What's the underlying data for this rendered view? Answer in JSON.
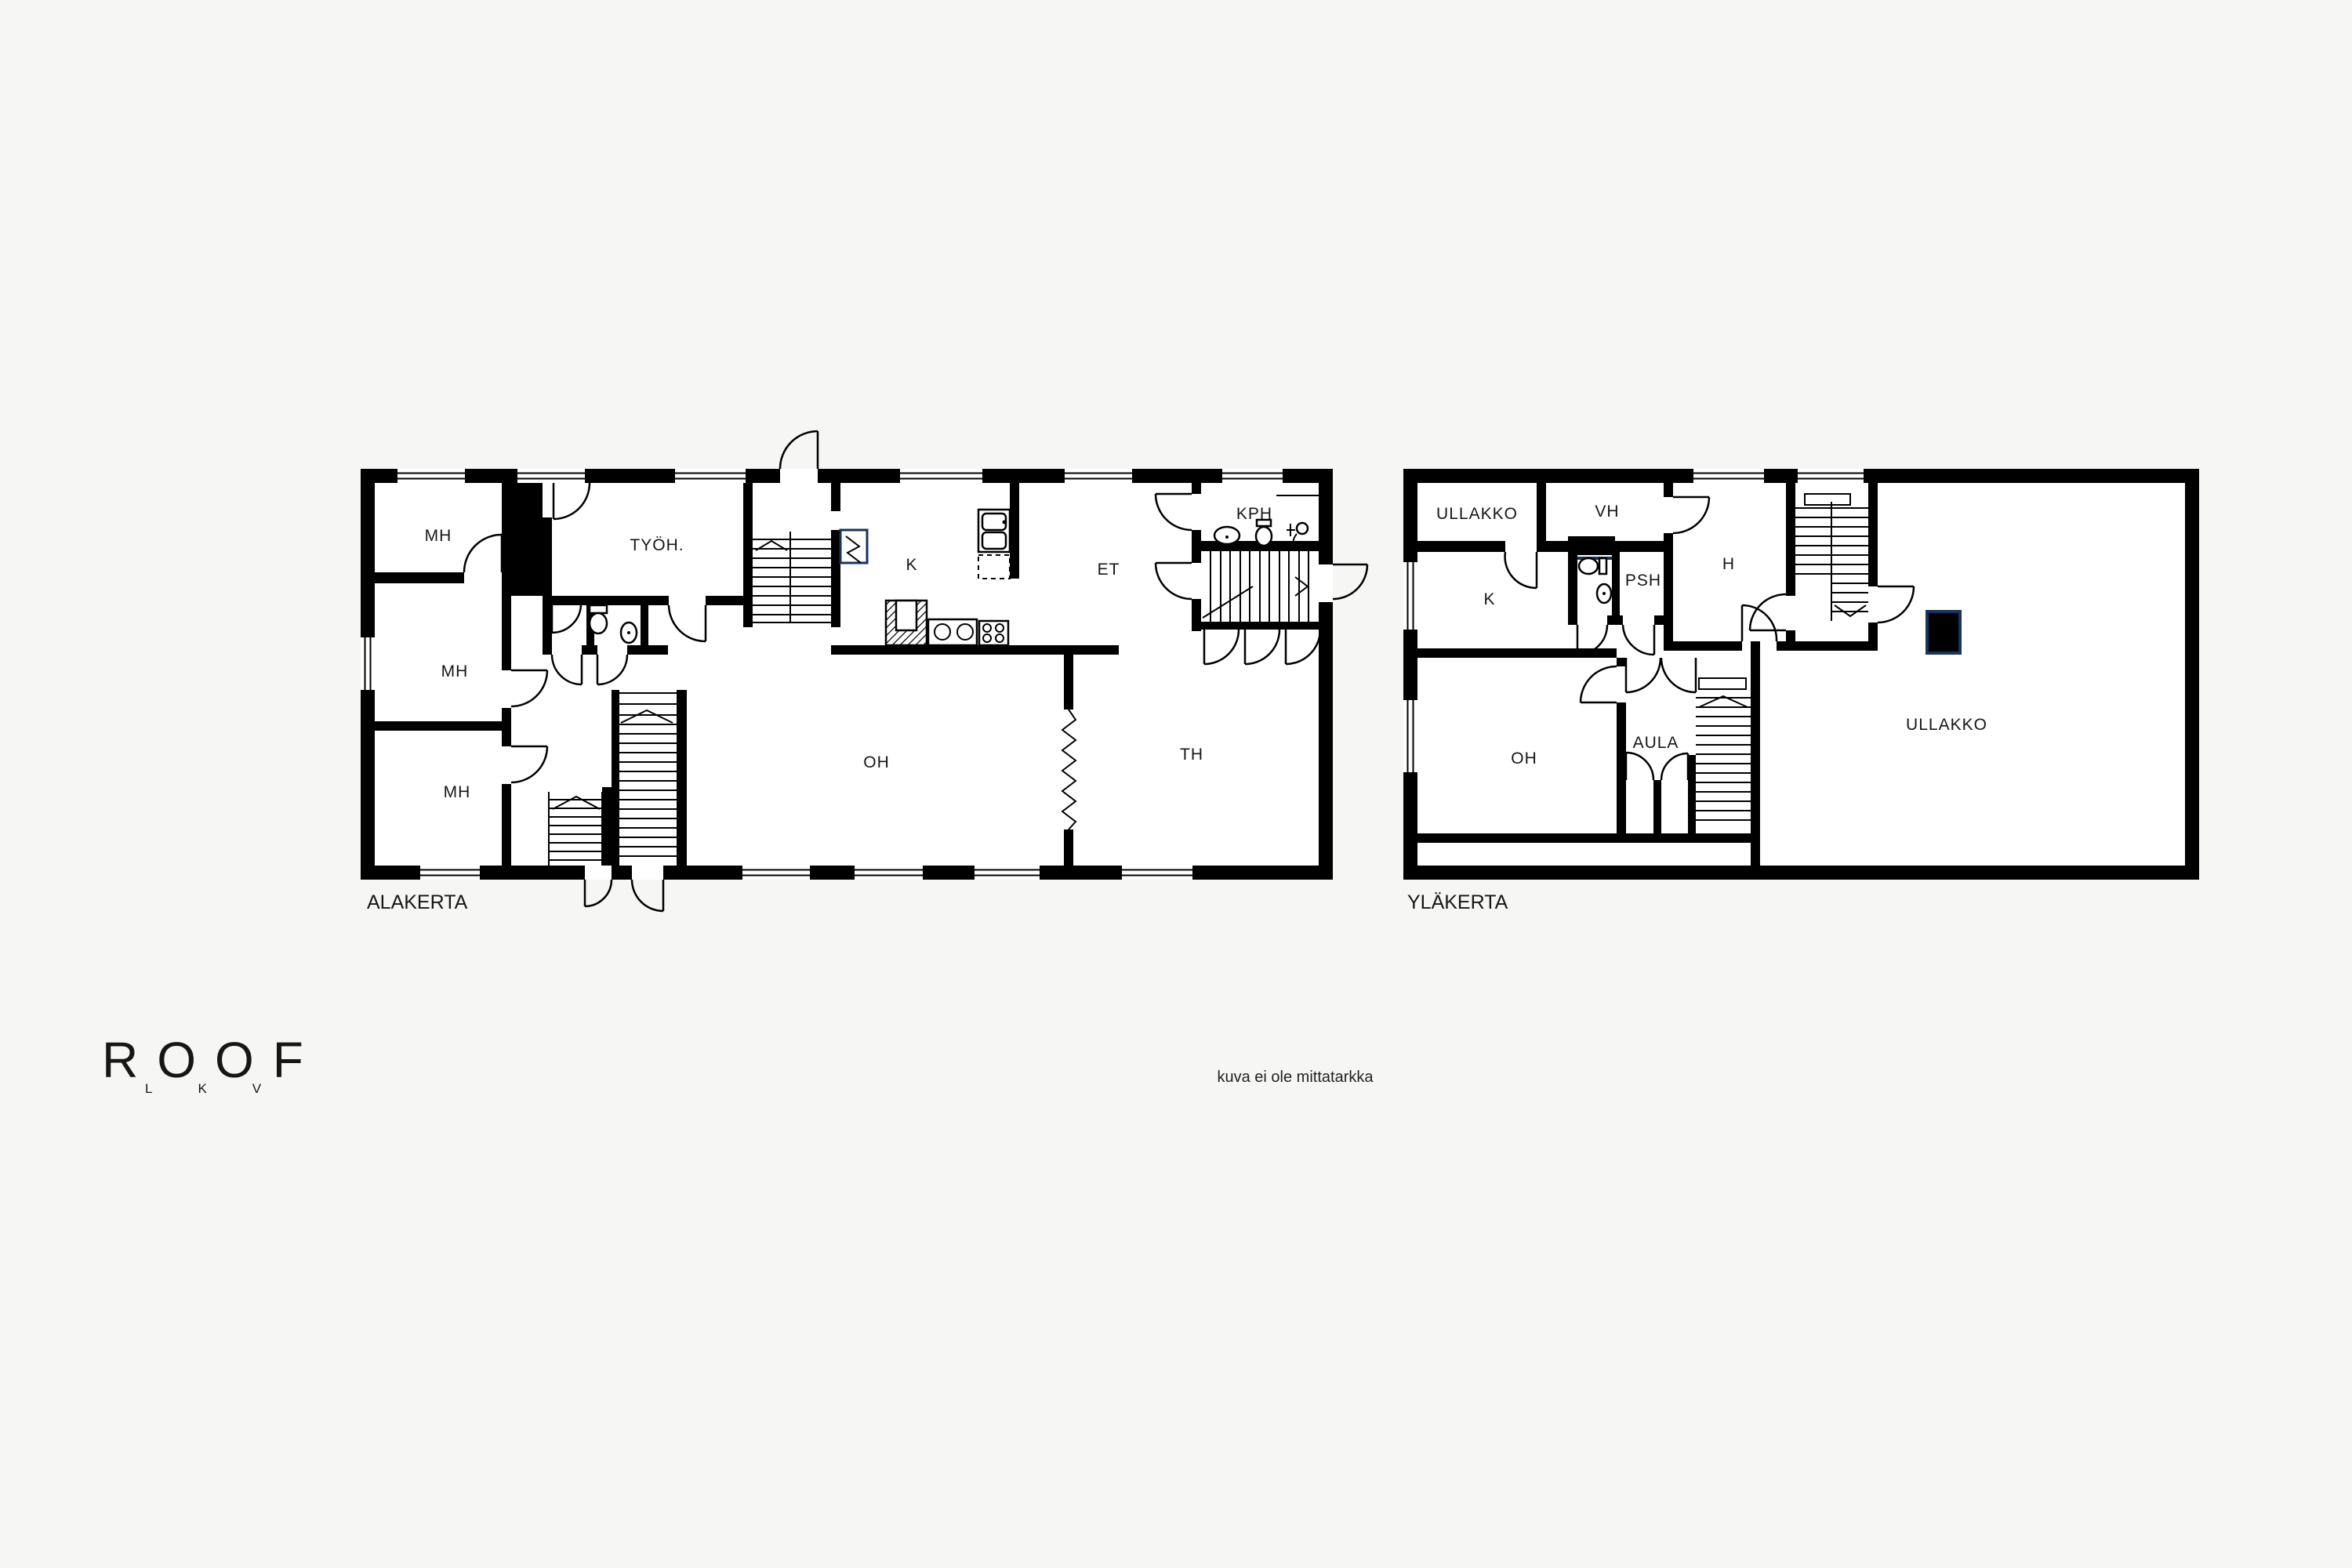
{
  "floors": {
    "alakerta": {
      "label": "ALAKERTA",
      "rooms": {
        "mh_top": "MH",
        "mh_mid": "MH",
        "mh_bottom": "MH",
        "tyohuone": "TYÖH.",
        "keittio": "K",
        "eteinen": "ET",
        "kylpyhuone": "KPH",
        "olohuone": "OH",
        "takkahuone": "TH"
      }
    },
    "ylakerta": {
      "label": "YLÄKERTA",
      "rooms": {
        "ullakko_left": "ULLAKKO",
        "vaatehuone": "VH",
        "keittio": "K",
        "pesuhuone": "PSH",
        "huone": "H",
        "olohuone": "OH",
        "aula": "AULA",
        "ullakko_main": "ULLAKKO"
      }
    }
  },
  "logo": {
    "title": "ROOF",
    "subtitle": "LKV"
  },
  "footnote": "kuva ei ole mittatarkka",
  "colors": {
    "wall": "#000000",
    "accent": "#16355a",
    "background": "#f6f6f5"
  }
}
